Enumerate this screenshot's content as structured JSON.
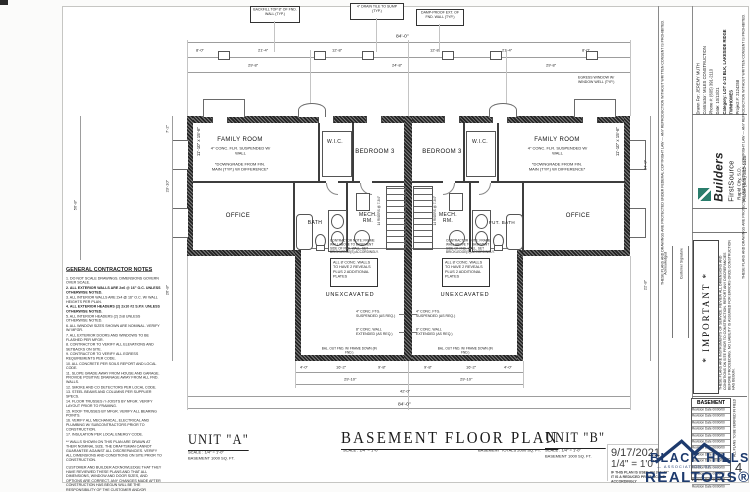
{
  "titles": {
    "unit_a": "UNIT \"A\"",
    "unit_a_scale": "SCALE : 1/4\" = 1'-0\"",
    "unit_a_area": "BASEMENT  1000 SQ. FT.",
    "plan_title": "BASEMENT FLOOR PLAN",
    "plan_scale": "SCALE : 1/4\" = 1'-0\"",
    "plan_total": "BASEMENT TOTALS 2000 SQ. FT.",
    "unit_b": "UNIT \"B\"",
    "unit_b_scale": "SCALE : 1/4\" = 1'-0\"",
    "unit_b_area": "BASEMENT  1000 SQ. FT."
  },
  "rooms": {
    "family": "FAMILY ROOM",
    "family_sub": "4\" CONC. FLR. SUSPENDED W/ WALL",
    "family_note": "*DOWNGRADE FROM FIN. MAIN (TYP.) W/ DIFFERENCE*",
    "family_size": "11'-10\" x 15'-6\"",
    "wic": "W.I.C.",
    "bedroom": "BEDROOM 3",
    "office": "OFFICE",
    "bath": "BATH",
    "fut_bath": "FUT. BATH",
    "mech_1": "MECH.",
    "mech_2": "RM.",
    "unexcavated": "UNEXCAVATED"
  },
  "notes": {
    "wall_note": "ALL 8' CONC. WALLS TO HAVE 2 REVEALS PLUS 2 ADDITIONAL PLATES",
    "contractor_note": "CONTRACTOR NOTE: FRAME WALL ABOVE TO BASEMENT SIDE OF FND. WALL. SET BRICKLEDGE(S) ACCORDINGLY.",
    "ftg_callout": "4\" CONC. FTG. SUSPENDED (AS REQ.)",
    "wall_callout": "8\" CONC. WALL EXTENDED (AS REQ.)",
    "bal_note": "BAL. OUT FND. W/ FRAME DOWN (IN FND.)",
    "egress_note": "EGRESS WINDOW W/ WINDOW WELL (TYP.)",
    "stair_note": "14 RISERS @ 7-3/4\"",
    "backfill_0": "BACKFILL TOP 8\" OF FND. WALL (TYP.)",
    "backfill_1": "4\" DRAIN TILE TO SUMP (TYP.)",
    "backfill_2": "DAMP-PROOF EXT. OF FND. WALL (TYP.)"
  },
  "dims": {
    "top_overall": "84'-0\"",
    "top_row2": [
      "8'-0\"",
      "21'-4\"",
      "12'-8\"",
      "12'-8\"",
      "21'-4\"",
      "8'-0\""
    ],
    "top_row3": [
      "29'-8\"",
      "24'-8\"",
      "29'-8\""
    ],
    "bottom_row1": [
      "4'-0\"",
      "16'-2\"",
      "9'-8\"",
      "9'-8\"",
      "16'-2\"",
      "4'-0\""
    ],
    "bottom_row2": [
      "29'-10\"",
      "29'-10\""
    ],
    "bottom_row3": "42'-0\"",
    "bottom_overall": "84'-0\"",
    "left": [
      "7'-2\"",
      "23'-10\"",
      "26'-8\"",
      "56'-8\""
    ],
    "right": [
      "34'-0\"",
      "22'-8\""
    ]
  },
  "general_notes": {
    "title": "GENERAL CONTRACTOR NOTES",
    "lines": [
      "1. DO NOT SCALE DRAWINGS. DIMENSIONS GOVERN OVER SCALE.",
      "2. ALL EXTERIOR WALLS ARE 2x6 @ 16\" O.C. UNLESS OTHERWISE NOTED.",
      "3. ALL INTERIOR WALLS ARE 2x4 @ 16\" O.C. W/ WALL HEIGHTS PER PLAN.",
      "4. ALL EXTERIOR HEADERS (2) 2x10 #2 S.P.F. UNLESS OTHERWISE NOTED.",
      "5. ALL INTERIOR HEADERS (2) 2x8 UNLESS OTHERWISE NOTED.",
      "6. ALL WINDOW SIZES SHOWN ARE NOMINAL. VERIFY W/ MFGR.",
      "7. ALL EXTERIOR DOORS AND WINDOWS TO BE FLASHED PER MFGR.",
      "8. CONTRACTOR TO VERIFY ALL ELEVATIONS AND SETBACKS ON SITE.",
      "9. CONTRACTOR TO VERIFY ALL EGRESS REQUIREMENTS PER CODE.",
      "10. ALL CONCRETE PER SOILS REPORT AND LOCAL CODE.",
      "11. SLOPE GRADE AWAY FROM HOUSE AND GARAGE. PROVIDE POSITIVE DRAINAGE AWAY FROM ALL FND. WALLS.",
      "12. SMOKE AND CO DETECTORS PER LOCAL CODE.",
      "13. STEEL BEAMS AND COLUMNS PER SUPPLIER SPECS.",
      "14. FLOOR TRUSSES / I-JOISTS BY MFGR. VERIFY LAYOUT PRIOR TO FRAMING.",
      "15. ROOF TRUSSES BY MFGR. VERIFY ALL BEARING POINTS.",
      "16. VERIFY ALL MECHANICAL, ELECTRICAL AND PLUMBING W/ SUBCONTRACTORS PRIOR TO CONSTRUCTION.",
      "17. INSULATION PER LOCAL ENERGY CODE."
    ],
    "para1": "** WALLS SHOWN ON THIS PLAN ARE DRAWN AT THEIR NOMINAL SIZE. THE DRAFTSMAN CANNOT GUARANTEE AGAINST ALL DISCREPANCIES. VERIFY ALL DIMENSIONS AND CONDITIONS ON SITE PRIOR TO CONSTRUCTION.",
    "para2": "CUSTOMER AND BUILDER ACKNOWLEDGE THAT THEY HAVE REVIEWED THESE PLANS AND THAT ALL DIMENSIONS, WINDOW AND DOOR SIZES, AND OPTIONS ARE CORRECT. ANY CHANGES MADE AFTER CONSTRUCTION HAS BEGUN WILL BE THE RESPONSIBILITY OF THE CUSTOMER AND/OR BUILDER. THE DRAFTSMAN ASSUMES NO LIABILITY FOR ERRORS AFTER CONSTRUCTION HAS BEGUN."
  },
  "titleblock": {
    "brand_top": "Builders",
    "brand_bottom": "FirstSource",
    "brand_city": "Rapid City, S.D.",
    "brand_phone": "Phone (605) 342-1125",
    "info_lines": [
      "Drawn For:  JEREMY MUTH",
      "Contractor:  MILES CONSTRUCTION",
      "Phone #:  (605) 391-2110",
      "Date:  10/13/21",
      "Category:  LOT 4-13 BLK, LAKESIDE RIDGE TWNHOMES",
      "Project #:  2124258"
    ],
    "important_title": "* IMPORTANT *",
    "important_text": "THESE PLANS ARE INSTRUMENTS OF SERVICE. REVIEW ALL DIMENSIONS AND CONDITIONS ON SITE PRIOR TO CONSTRUCTION. REPORT ANY DISCREPANCIES BEFORE PROCEEDING. NO LIABILITY IS ASSUMED FOR ERRORS ONCE CONSTRUCTION HAS BEGUN.",
    "ack_label": "Acknowledged",
    "sig_label": "Customer Signature",
    "copyright": "THESE PLANS AND DRAWINGS ARE PROTECTED UNDER FEDERAL COPYRIGHT LAW — ANY REPRODUCTION WITHOUT WRITTEN CONSENT IS PROHIBITED.",
    "side_note": "ALL PLANS TO BE VERIFIED IN FIELD",
    "revisions_header": "BASEMENT",
    "revision_row": "Revision Date  00/00/00"
  },
  "stamp": {
    "date": "9/17/2021",
    "scale": "1/4\" = 1'0\"",
    "note": "IF THIS PLAN IS USED ON 24\"x36\" IT IS A REDUCED PRINT. SCALE ACCORDINGLY"
  },
  "realtors": {
    "line1": "BLACK HILLS",
    "line2": "— ASSOCIATION OF —",
    "line3": "REALTORS®",
    "color": "#1d3a6d"
  },
  "page_number": "4"
}
